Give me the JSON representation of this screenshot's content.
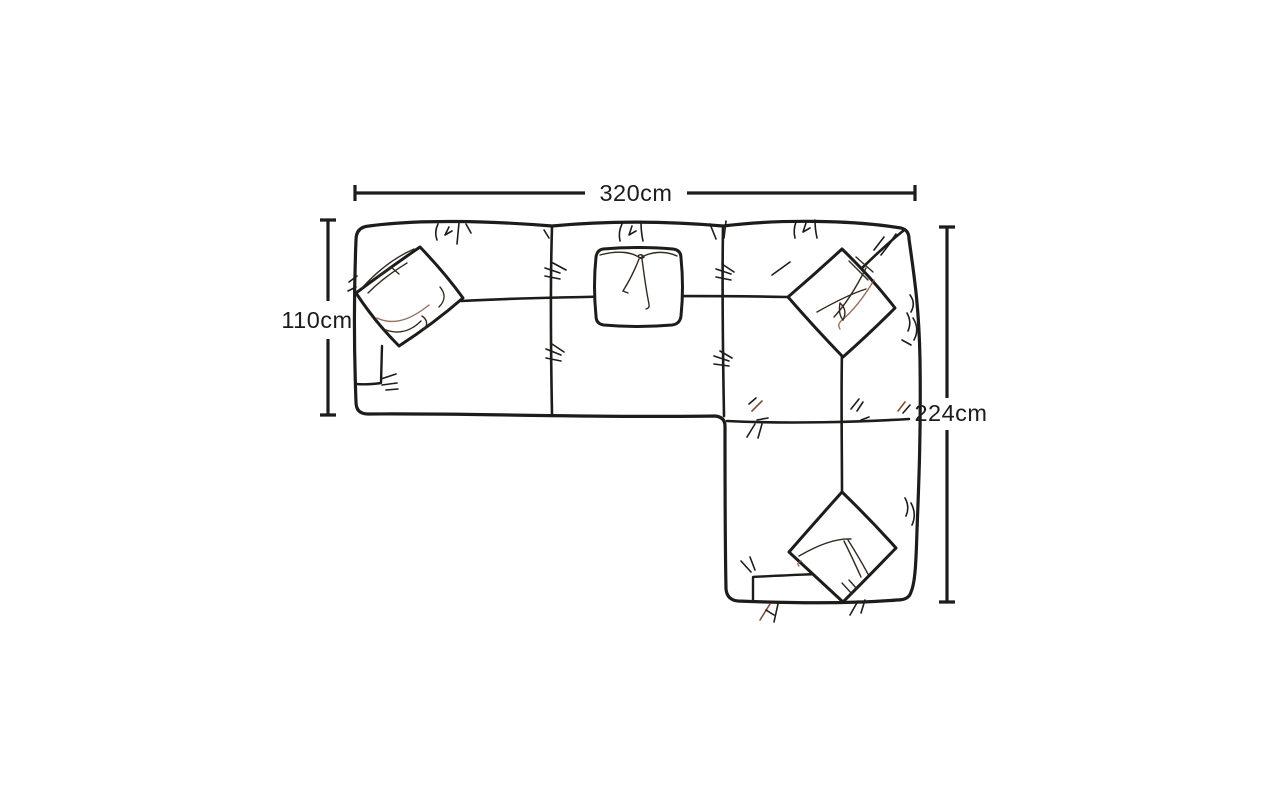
{
  "page": {
    "background": "#ffffff"
  },
  "diagram": {
    "type": "furniture-dimension-diagram",
    "subject": "corner sofa with right chaise, top view",
    "style": "hand-drawn ink sketch",
    "ink_color": "#1c1c1a",
    "units": "cm",
    "dimensions": {
      "width_top": {
        "label": "320cm",
        "value_cm": 320
      },
      "depth_left": {
        "label": "110cm",
        "value_cm": 110
      },
      "length_right": {
        "label": "224cm",
        "value_cm": 224
      }
    },
    "features": {
      "scatter_cushions": 4,
      "chaise_position": "bottom-right"
    }
  }
}
